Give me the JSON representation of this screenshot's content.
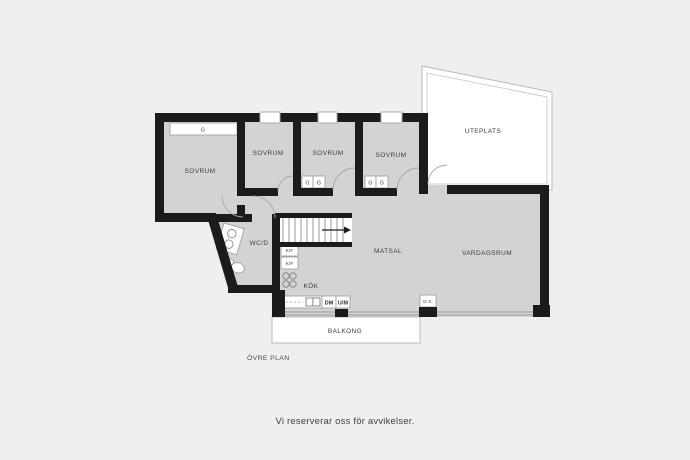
{
  "floorplan": {
    "plan_title": "ÖVRE PLAN",
    "rooms": {
      "bedroom1": "SOVRUM",
      "bedroom2": "SOVRUM",
      "bedroom3": "SOVRUM",
      "bedroom4": "SOVRUM",
      "patio": "UTEPLATS",
      "bathroom": "WC/D",
      "kitchen": "KÖK",
      "dining_room": "MATSAL",
      "living_room": "VARDAGSRUM",
      "balcony": "BALKONG"
    },
    "labels": {
      "wardrobe": "G",
      "fridge_freezer": "K/F",
      "dishwasher": "DM",
      "oven_microwave": "U/M",
      "fireplace": "O.S."
    },
    "colors": {
      "background": "#efefee",
      "floor": "#d3d3d2",
      "wall": "#1b1b1b",
      "outdoor_fill": "#ffffff",
      "thin_line": "#9a9a9a",
      "text": "#3d3d3d"
    }
  },
  "footer": {
    "disclaimer": "Vi reserverar oss för avvikelser."
  }
}
